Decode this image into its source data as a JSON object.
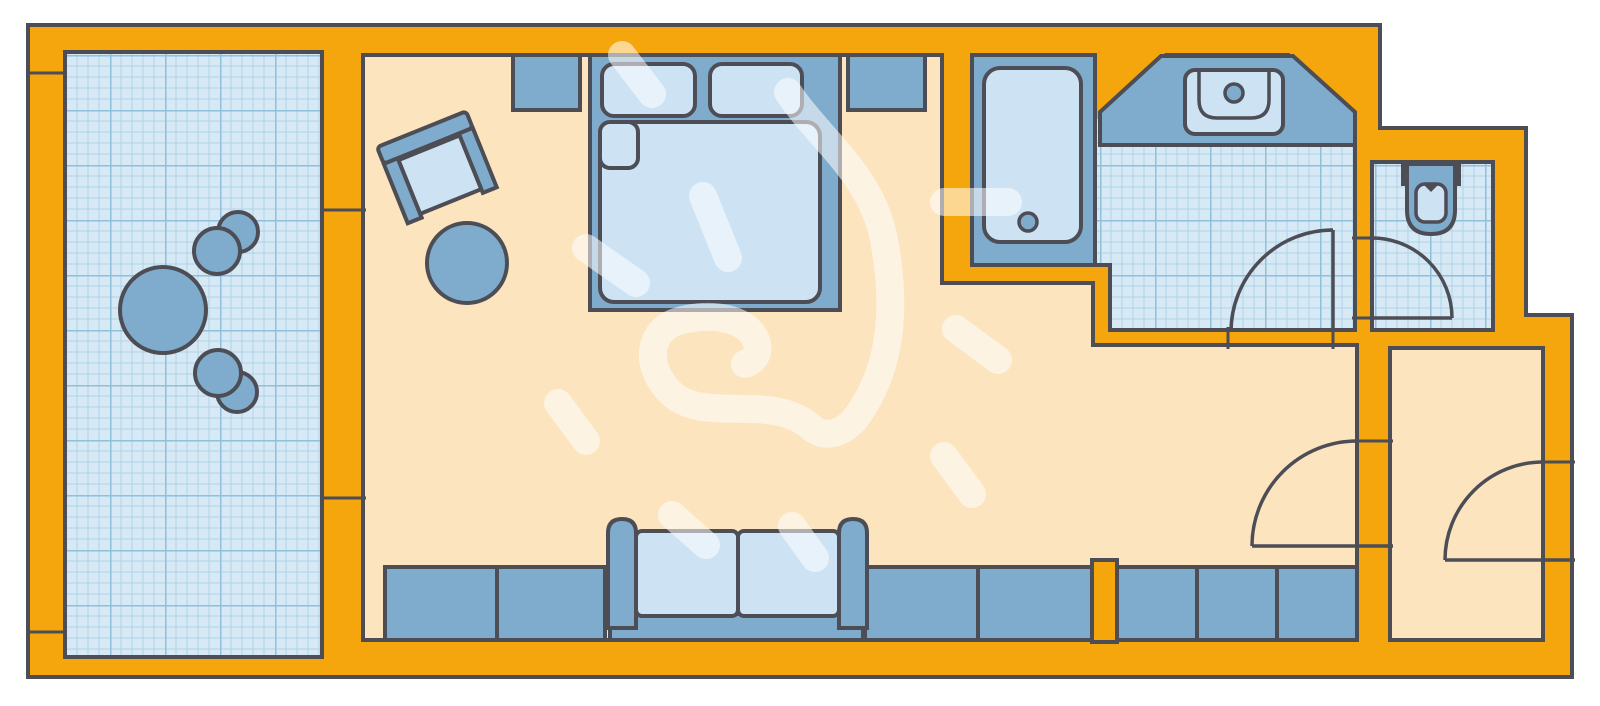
{
  "app": {
    "name": "hotel-room-floor-plan"
  },
  "canvas": {
    "width": 1600,
    "height": 706,
    "background": "#ffffff"
  },
  "colors": {
    "wall": "#F5A60D",
    "outline": "#4D4D56",
    "floor": "#FBE4BE",
    "tile_bg": "#D7E9F5",
    "tile_fine": "#AFD2E7",
    "tile_major": "#8FC0DC",
    "blue": "#7FACCC",
    "light": "#CDE3F3",
    "wm": "rgba(255,255,255,0.55)"
  },
  "plan": {
    "footprint": {
      "name": "building-outline",
      "shapes": [
        {
          "t": "polygon",
          "pts": [
            [
              28,
              25
            ],
            [
              1380,
              25
            ],
            [
              1380,
              128
            ],
            [
              1526,
              128
            ],
            [
              1526,
              315
            ],
            [
              1572,
              315
            ],
            [
              1572,
              677
            ],
            [
              28,
              677
            ]
          ],
          "fill": "wall",
          "sw": 4
        }
      ]
    },
    "rooms": [
      {
        "name": "room-balcony",
        "shapes": [
          {
            "t": "rect",
            "x": 65,
            "y": 52,
            "w": 257,
            "h": 605,
            "fill": "tile",
            "sw": 4
          }
        ]
      },
      {
        "name": "room-main",
        "shapes": [
          {
            "t": "polygon",
            "pts": [
              [
                363,
                55
              ],
              [
                942,
                55
              ],
              [
                942,
                283
              ],
              [
                1093,
                283
              ],
              [
                1093,
                345
              ],
              [
                1357,
                345
              ],
              [
                1357,
                640
              ],
              [
                363,
                640
              ]
            ],
            "fill": "floor",
            "sw": 4
          }
        ]
      },
      {
        "name": "room-bathroom",
        "shapes": [
          {
            "t": "polygon",
            "pts": [
              [
                1095,
                55
              ],
              [
                1355,
                55
              ],
              [
                1355,
                330
              ],
              [
                1110,
                330
              ],
              [
                1110,
                265
              ],
              [
                1095,
                265
              ]
            ],
            "fill": "tile",
            "sw": 4
          }
        ]
      },
      {
        "name": "room-wc",
        "shapes": [
          {
            "t": "rect",
            "x": 1372,
            "y": 162,
            "w": 121,
            "h": 168,
            "fill": "tile",
            "sw": 4
          }
        ]
      },
      {
        "name": "room-hall",
        "shapes": [
          {
            "t": "rect",
            "x": 1390,
            "y": 348,
            "w": 153,
            "h": 292,
            "fill": "floor",
            "sw": 4
          }
        ]
      }
    ],
    "wall_features": [
      {
        "name": "vanity-corner-wedge-left",
        "shapes": [
          {
            "t": "polygon",
            "pts": [
              [
                1097,
                51
              ],
              [
                1167,
                51
              ],
              [
                1101,
                119
              ],
              [
                1097,
                119
              ]
            ],
            "fill": "wall",
            "sw": 0
          }
        ]
      },
      {
        "name": "vanity-corner-wedge-right",
        "shapes": [
          {
            "t": "polygon",
            "pts": [
              [
                1287,
                51
              ],
              [
                1359,
                51
              ],
              [
                1359,
                117
              ]
            ],
            "fill": "wall",
            "sw": 0
          }
        ]
      },
      {
        "name": "wall-pillar",
        "shapes": [
          {
            "t": "rect",
            "x": 1092,
            "y": 560,
            "w": 25,
            "h": 82,
            "fill": "wall",
            "sw": 4
          }
        ]
      },
      {
        "name": "balcony-window-joints",
        "shapes": [
          {
            "t": "line",
            "x1": 320,
            "y1": 210,
            "x2": 366,
            "y2": 210,
            "sw": 3
          },
          {
            "t": "line",
            "x1": 320,
            "y1": 498,
            "x2": 366,
            "y2": 498,
            "sw": 3
          }
        ]
      },
      {
        "name": "balcony-rail-joints",
        "shapes": [
          {
            "t": "line",
            "x1": 26,
            "y1": 73,
            "x2": 67,
            "y2": 73,
            "sw": 3
          },
          {
            "t": "line",
            "x1": 26,
            "y1": 632,
            "x2": 67,
            "y2": 632,
            "sw": 3
          }
        ]
      }
    ],
    "furniture": [
      {
        "name": "balcony-chair-top",
        "shapes": [
          {
            "t": "circle",
            "cx": 238,
            "cy": 232,
            "r": 20,
            "fill": "blue",
            "sw": 4
          },
          {
            "t": "circle",
            "cx": 217,
            "cy": 251,
            "r": 23,
            "fill": "blue",
            "sw": 4
          }
        ]
      },
      {
        "name": "balcony-chair-bottom",
        "shapes": [
          {
            "t": "circle",
            "cx": 237,
            "cy": 392,
            "r": 20,
            "fill": "blue",
            "sw": 4
          },
          {
            "t": "circle",
            "cx": 218,
            "cy": 373,
            "r": 23,
            "fill": "blue",
            "sw": 4
          }
        ]
      },
      {
        "name": "balcony-table",
        "shapes": [
          {
            "t": "circle",
            "cx": 163,
            "cy": 310,
            "r": 43,
            "fill": "blue",
            "sw": 4
          }
        ]
      },
      {
        "name": "desk-chair",
        "transform": "rotate(-22 438 170)",
        "shapes": [
          {
            "t": "rect",
            "x": 390,
            "y": 126,
            "w": 96,
            "h": 18,
            "rx": 4,
            "fill": "blue",
            "sw": 4
          },
          {
            "t": "rect",
            "x": 405,
            "y": 146,
            "w": 66,
            "h": 58,
            "fill": "light",
            "sw": 4
          },
          {
            "t": "rect",
            "x": 390,
            "y": 144,
            "w": 15,
            "h": 64,
            "fill": "blue",
            "sw": 4
          },
          {
            "t": "rect",
            "x": 471,
            "y": 144,
            "w": 15,
            "h": 64,
            "fill": "blue",
            "sw": 4
          }
        ]
      },
      {
        "name": "ottoman",
        "shapes": [
          {
            "t": "circle",
            "cx": 467,
            "cy": 263,
            "r": 40,
            "fill": "blue",
            "sw": 4
          }
        ]
      },
      {
        "name": "nightstand-left",
        "shapes": [
          {
            "t": "rect",
            "x": 513,
            "y": 55,
            "w": 67,
            "h": 55,
            "fill": "blue",
            "sw": 4
          }
        ]
      },
      {
        "name": "nightstand-right",
        "shapes": [
          {
            "t": "rect",
            "x": 848,
            "y": 55,
            "w": 77,
            "h": 55,
            "fill": "blue",
            "sw": 4
          }
        ]
      },
      {
        "name": "double-bed",
        "shapes": [
          {
            "t": "rect",
            "x": 590,
            "y": 55,
            "w": 250,
            "h": 255,
            "fill": "blue",
            "sw": 4
          },
          {
            "t": "rect",
            "x": 602,
            "y": 64,
            "w": 93,
            "h": 52,
            "rx": 12,
            "fill": "light",
            "sw": 4
          },
          {
            "t": "rect",
            "x": 710,
            "y": 64,
            "w": 92,
            "h": 52,
            "rx": 12,
            "fill": "light",
            "sw": 4
          },
          {
            "t": "rect",
            "x": 600,
            "y": 122,
            "w": 220,
            "h": 180,
            "rx": 14,
            "fill": "light",
            "sw": 4
          },
          {
            "t": "rect",
            "x": 600,
            "y": 122,
            "w": 38,
            "h": 46,
            "rx": 10,
            "fill": "light",
            "sw": 4
          }
        ]
      },
      {
        "name": "bathtub",
        "shapes": [
          {
            "t": "rect",
            "x": 972,
            "y": 55,
            "w": 123,
            "h": 210,
            "fill": "blue",
            "sw": 4
          },
          {
            "t": "rect",
            "x": 984,
            "y": 68,
            "w": 97,
            "h": 174,
            "rx": 16,
            "fill": "light",
            "sw": 4
          },
          {
            "t": "circle",
            "cx": 1028,
            "cy": 222,
            "r": 9,
            "fill": "blue",
            "sw": 3.5
          }
        ]
      },
      {
        "name": "vanity-counter",
        "shapes": [
          {
            "t": "polygon",
            "pts": [
              [
                1100,
                145
              ],
              [
                1100,
                112
              ],
              [
                1161,
                56
              ],
              [
                1293,
                56
              ],
              [
                1355,
                112
              ],
              [
                1355,
                145
              ]
            ],
            "fill": "blue",
            "sw": 4
          }
        ]
      },
      {
        "name": "sink",
        "shapes": [
          {
            "t": "rect",
            "x": 1185,
            "y": 70,
            "w": 98,
            "h": 64,
            "rx": 10,
            "fill": "light",
            "sw": 4
          },
          {
            "t": "path",
            "d": "M1199,70 L1199,100 Q1199,118 1217,118 L1251,118 Q1269,118 1269,100 L1269,70",
            "fill": "none",
            "sw": 3.5
          },
          {
            "t": "circle",
            "cx": 1234,
            "cy": 93,
            "r": 9,
            "fill": "blue",
            "sw": 3.5
          }
        ]
      },
      {
        "name": "toilet",
        "shapes": [
          {
            "t": "rect",
            "x": 1403,
            "y": 162,
            "w": 56,
            "h": 22,
            "fill": "blue",
            "sw": 4
          },
          {
            "t": "path",
            "d": "M1407,164 L1455,164 L1455,210 Q1455,234 1431,234 Q1407,234 1407,210 Z",
            "fill": "blue",
            "sw": 4
          },
          {
            "t": "rect",
            "x": 1416,
            "y": 184,
            "w": 30,
            "h": 38,
            "rx": 9,
            "fill": "light",
            "sw": 3.5
          },
          {
            "t": "path",
            "d": "M1423,184 L1431,192 L1439,184 Z",
            "fill": "outline",
            "sw": 0
          }
        ]
      },
      {
        "name": "wardrobe-row-left",
        "shapes": [
          {
            "t": "rect",
            "x": 385,
            "y": 567,
            "w": 112,
            "h": 73,
            "fill": "blue",
            "sw": 4
          },
          {
            "t": "rect",
            "x": 497,
            "y": 567,
            "w": 108,
            "h": 73,
            "fill": "blue",
            "sw": 4
          },
          {
            "t": "rect",
            "x": 865,
            "y": 567,
            "w": 113,
            "h": 73,
            "fill": "blue",
            "sw": 4
          },
          {
            "t": "rect",
            "x": 978,
            "y": 567,
            "w": 114,
            "h": 73,
            "fill": "blue",
            "sw": 4
          }
        ]
      },
      {
        "name": "wardrobe-row-right",
        "shapes": [
          {
            "t": "rect",
            "x": 1117,
            "y": 567,
            "w": 80,
            "h": 73,
            "fill": "blue",
            "sw": 4
          },
          {
            "t": "rect",
            "x": 1197,
            "y": 567,
            "w": 80,
            "h": 73,
            "fill": "blue",
            "sw": 4
          },
          {
            "t": "rect",
            "x": 1277,
            "y": 567,
            "w": 80,
            "h": 73,
            "fill": "blue",
            "sw": 4
          }
        ]
      },
      {
        "name": "sofa",
        "shapes": [
          {
            "t": "rect",
            "x": 610,
            "y": 614,
            "w": 253,
            "h": 26,
            "fill": "blue",
            "sw": 4
          },
          {
            "t": "rect",
            "x": 636,
            "y": 531,
            "w": 102,
            "h": 85,
            "rx": 6,
            "fill": "light",
            "sw": 4
          },
          {
            "t": "rect",
            "x": 738,
            "y": 531,
            "w": 101,
            "h": 85,
            "rx": 6,
            "fill": "light",
            "sw": 4
          },
          {
            "t": "path",
            "d": "M608,628 L608,533 Q608,519 622,519 Q636,519 636,533 L636,628 Z",
            "fill": "blue",
            "sw": 4
          },
          {
            "t": "path",
            "d": "M839,628 L839,533 Q839,519 853,519 Q867,519 867,533 L867,628 Z",
            "fill": "blue",
            "sw": 4
          }
        ]
      }
    ],
    "doors": [
      {
        "name": "door-bathroom",
        "shapes": [
          {
            "t": "line",
            "x1": 1228,
            "y1": 327,
            "x2": 1228,
            "y2": 349,
            "sw": 3
          },
          {
            "t": "line",
            "x1": 1333,
            "y1": 327,
            "x2": 1333,
            "y2": 349,
            "sw": 3
          },
          {
            "t": "line",
            "x1": 1333,
            "y1": 230,
            "x2": 1333,
            "y2": 332,
            "sw": 3.5
          },
          {
            "t": "path",
            "d": "M1231,332 A102,102 0 0 1 1333,230",
            "fill": "none",
            "sw": 3.5
          }
        ]
      },
      {
        "name": "door-wc",
        "shapes": [
          {
            "t": "line",
            "x1": 1352,
            "y1": 238,
            "x2": 1375,
            "y2": 238,
            "sw": 3
          },
          {
            "t": "line",
            "x1": 1352,
            "y1": 318,
            "x2": 1375,
            "y2": 318,
            "sw": 3
          },
          {
            "t": "line",
            "x1": 1372,
            "y1": 318,
            "x2": 1452,
            "y2": 318,
            "sw": 3.5
          },
          {
            "t": "path",
            "d": "M1372,238 A80,80 0 0 1 1452,318",
            "fill": "none",
            "sw": 3.5
          }
        ]
      },
      {
        "name": "door-main-room",
        "shapes": [
          {
            "t": "line",
            "x1": 1354,
            "y1": 441,
            "x2": 1393,
            "y2": 441,
            "sw": 3
          },
          {
            "t": "line",
            "x1": 1252,
            "y1": 546,
            "x2": 1393,
            "y2": 546,
            "sw": 3.5
          },
          {
            "t": "path",
            "d": "M1252,546 A105,105 0 0 1 1357,441",
            "fill": "none",
            "sw": 3.5
          }
        ]
      },
      {
        "name": "door-entry",
        "shapes": [
          {
            "t": "line",
            "x1": 1540,
            "y1": 462,
            "x2": 1575,
            "y2": 462,
            "sw": 3
          },
          {
            "t": "line",
            "x1": 1445,
            "y1": 560,
            "x2": 1575,
            "y2": 560,
            "sw": 3.5
          },
          {
            "t": "path",
            "d": "M1445,560 A98,98 0 0 1 1543,462",
            "fill": "none",
            "sw": 3.5
          }
        ]
      }
    ],
    "watermark": {
      "name": "watermark-heart-sketch",
      "shapes": [
        {
          "t": "path",
          "d": "M788,92 C820,140 872,175 884,240 C896,305 893,365 858,415 C846,432 826,440 812,428 C772,392 706,424 672,394 C644,368 648,332 676,322 C702,313 740,315 753,335 C762,348 757,360 745,364",
          "fill": "none",
          "stroke": "wm",
          "sw": 28,
          "cap": "round"
        },
        {
          "t": "line",
          "x1": 622,
          "y1": 55,
          "x2": 652,
          "y2": 94,
          "stroke": "wm",
          "sw": 28,
          "cap": "round"
        },
        {
          "t": "line",
          "x1": 703,
          "y1": 196,
          "x2": 728,
          "y2": 258,
          "stroke": "wm",
          "sw": 28,
          "cap": "round"
        },
        {
          "t": "line",
          "x1": 586,
          "y1": 248,
          "x2": 636,
          "y2": 283,
          "stroke": "wm",
          "sw": 28,
          "cap": "round"
        },
        {
          "t": "line",
          "x1": 558,
          "y1": 403,
          "x2": 586,
          "y2": 441,
          "stroke": "wm",
          "sw": 28,
          "cap": "round"
        },
        {
          "t": "line",
          "x1": 956,
          "y1": 329,
          "x2": 998,
          "y2": 360,
          "stroke": "wm",
          "sw": 28,
          "cap": "round"
        },
        {
          "t": "line",
          "x1": 944,
          "y1": 456,
          "x2": 972,
          "y2": 494,
          "stroke": "wm",
          "sw": 28,
          "cap": "round"
        },
        {
          "t": "line",
          "x1": 672,
          "y1": 515,
          "x2": 706,
          "y2": 545,
          "stroke": "wm",
          "sw": 28,
          "cap": "round"
        },
        {
          "t": "line",
          "x1": 792,
          "y1": 526,
          "x2": 815,
          "y2": 558,
          "stroke": "wm",
          "sw": 28,
          "cap": "round"
        },
        {
          "t": "line",
          "x1": 944,
          "y1": 202,
          "x2": 1008,
          "y2": 202,
          "stroke": "wm",
          "sw": 28,
          "cap": "round"
        }
      ]
    }
  }
}
